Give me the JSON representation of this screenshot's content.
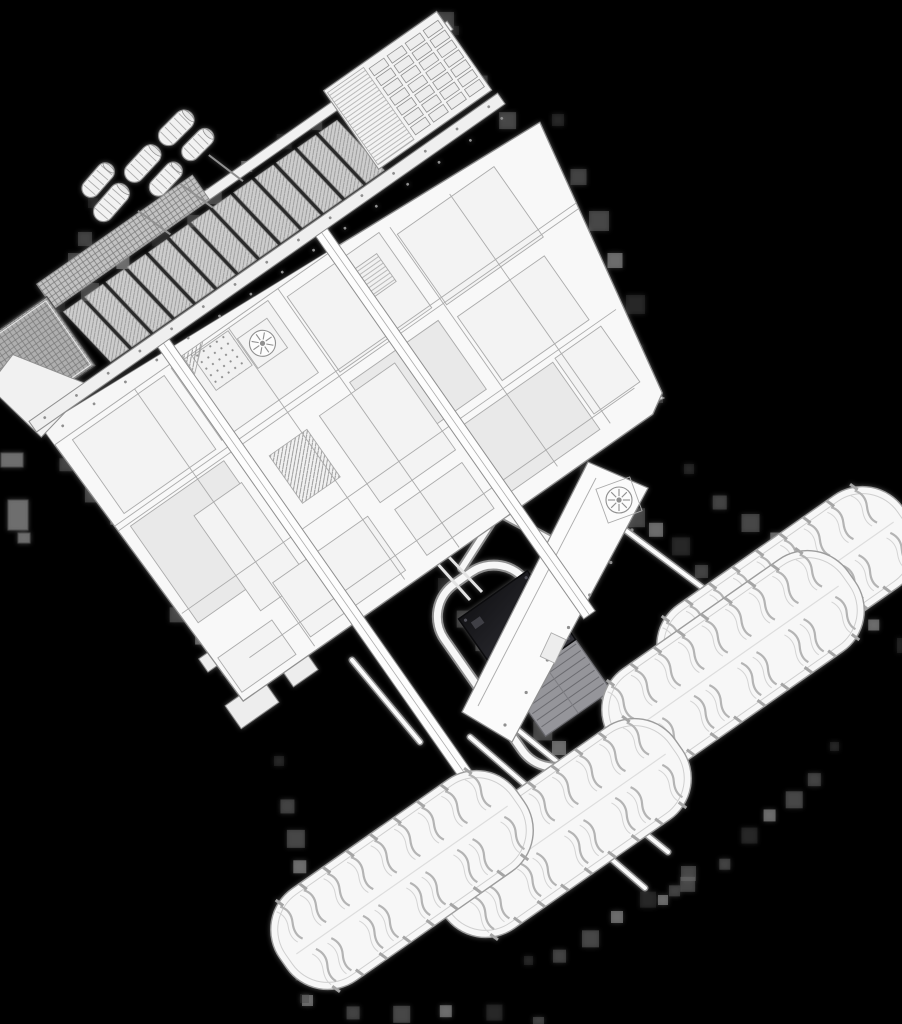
{
  "scene": {
    "description": "Monochrome 3D wireframe render of a combine harvester style machine viewed from above, rotated diagonally on a black background, with slatted header, paneled deck, dark engine block, tubular rear frame, hitch ring and four treaded tires",
    "canvas": {
      "width": 902,
      "height": 1024
    },
    "palette": {
      "background": "#000000",
      "body_fill": "#f8f8f8",
      "panel_base": "#f3f3f3",
      "panel_shaded": "#e9e9e9",
      "part_fill": "#f2f2f2",
      "line_mid": "#8f8f8f",
      "line_soft": "#ababab",
      "line_dark": "#5a5a5a",
      "slat_fill": "#cdcdcd",
      "grid_fill": "#aeaeae",
      "engine_dark_1": "#141417",
      "engine_dark_2": "#303036",
      "engine_rib_fill": "#95959a",
      "engine_rib_line": "#6b6b70",
      "tire_fill": "#f7f7f7",
      "tire_line": "#9c9c9c",
      "tread_line": "#b4b4b4",
      "tread_echo": "#d4d4d4",
      "artifact_grays": [
        "#3c3c3c",
        "#565656",
        "#707070",
        "#8b8b8b"
      ]
    },
    "machine": {
      "anchor_x": 20,
      "anchor_y": 330,
      "rotation_deg": -35
    },
    "header": {
      "front_rail": {
        "x": -45,
        "y": -8,
        "w": 572,
        "h": 10
      },
      "upper_strip": {
        "x": 40,
        "y": -28,
        "w": 190,
        "h": 30
      },
      "slats": {
        "count": 13,
        "x0": 46,
        "step": 26,
        "w": 22,
        "y": 10,
        "h": 68,
        "skew": 10
      },
      "left_grid": {
        "x": -45,
        "y": -12,
        "w": 86,
        "h": 84
      },
      "wing_points": "-58,28 -20,16 26,86 -44,100",
      "sieve": {
        "x": 386,
        "y": -22,
        "w": 138,
        "h": 96,
        "stripe_w": 44,
        "cols": 4,
        "rows": 7,
        "cx0": 436,
        "ry0": -14,
        "colstep": 22,
        "rowstep": 12,
        "cellw": 18,
        "cellh": 9
      },
      "rear_rail": {
        "x": -45,
        "y": 80,
        "w": 572,
        "h": 13
      },
      "rear_bolts": {
        "x1": -30,
        "y1": 86,
        "x2": 512,
        "y2": 86,
        "n": 15,
        "r": 1.4
      },
      "cylinders": [
        {
          "x": 148,
          "y": -52,
          "w": 44,
          "h": 20,
          "rot": -14
        },
        {
          "x": 150,
          "y": -78,
          "w": 40,
          "h": 18,
          "rot": -14
        },
        {
          "x": 196,
          "y": -66,
          "w": 44,
          "h": 20,
          "rot": -12
        },
        {
          "x": 206,
          "y": -40,
          "w": 40,
          "h": 18,
          "rot": -12
        },
        {
          "x": 244,
          "y": -76,
          "w": 42,
          "h": 20,
          "rot": -10
        },
        {
          "x": 252,
          "y": -50,
          "w": 38,
          "h": 18,
          "rot": -10
        }
      ],
      "arms": [
        {
          "x1": 165,
          "y1": -30,
          "x2": 178,
          "y2": 8
        },
        {
          "x1": 215,
          "y1": -28,
          "x2": 228,
          "y2": 10
        },
        {
          "x1": 255,
          "y1": -35,
          "x2": 268,
          "y2": 6
        }
      ]
    },
    "body": {
      "outline_points": "-38,92 545,128 490,420 470,432 -30,432",
      "walkway": {
        "x": -38,
        "y": 92,
        "w": 580,
        "h": 22
      },
      "walkway_bolts": {
        "x1": -20,
        "y1": 103,
        "x2": 516,
        "y2": 103,
        "n": 15,
        "r": 1.4
      },
      "panels": [
        {
          "x": -20,
          "y": 120,
          "w": 112,
          "h": 90,
          "fill": "base"
        },
        {
          "x": -22,
          "y": 224,
          "w": 114,
          "h": 118,
          "fill": "shaded"
        },
        {
          "x": 102,
          "y": 118,
          "w": 118,
          "h": 88,
          "fill": "base"
        },
        {
          "x": 126,
          "y": 120,
          "w": 44,
          "h": 42,
          "fill": "dots"
        },
        {
          "x": 238,
          "y": 126,
          "w": 112,
          "h": 92,
          "fill": "base"
        },
        {
          "x": 240,
          "y": 232,
          "w": 108,
          "h": 84,
          "fill": "shaded"
        },
        {
          "x": 364,
          "y": 138,
          "w": 118,
          "h": 86,
          "fill": "base"
        },
        {
          "x": 366,
          "y": 240,
          "w": 106,
          "h": 78,
          "fill": "base"
        },
        {
          "x": 36,
          "y": 252,
          "w": 58,
          "h": 116,
          "fill": "base"
        },
        {
          "x": 132,
          "y": 246,
          "w": 46,
          "h": 58,
          "fill": "hatch"
        },
        {
          "x": 196,
          "y": 242,
          "w": 92,
          "h": 106,
          "fill": "base"
        },
        {
          "x": 300,
          "y": 332,
          "w": 118,
          "h": 82,
          "fill": "shaded"
        },
        {
          "x": 62,
          "y": 352,
          "w": 116,
          "h": 66,
          "fill": "base"
        },
        {
          "x": 204,
          "y": 362,
          "w": 82,
          "h": 56,
          "fill": "base"
        },
        {
          "x": 422,
          "y": 330,
          "w": 56,
          "h": 68,
          "fill": "base"
        },
        {
          "x": -26,
          "y": 382,
          "w": 66,
          "h": 42,
          "fill": "base"
        },
        {
          "x": 302,
          "y": 142,
          "w": 34,
          "h": 34,
          "fill": "stripes"
        }
      ],
      "lines": [
        {
          "x1": 60,
          "y1": 95,
          "x2": 60,
          "y2": 428
        },
        {
          "x1": 172,
          "y1": 118,
          "x2": 172,
          "y2": 425
        },
        {
          "x1": 235,
          "y1": 95,
          "x2": 235,
          "y2": 430
        },
        {
          "x1": 362,
          "y1": 128,
          "x2": 362,
          "y2": 420
        },
        {
          "x1": 430,
          "y1": 135,
          "x2": 430,
          "y2": 415
        },
        {
          "x1": -36,
          "y1": 215,
          "x2": 540,
          "y2": 215
        },
        {
          "x1": -36,
          "y1": 221,
          "x2": 540,
          "y2": 221
        },
        {
          "x1": -30,
          "y1": 325,
          "x2": 500,
          "y2": 325
        },
        {
          "x1": -38,
          "y1": 114,
          "x2": 543,
          "y2": 114
        },
        {
          "x1": 0,
          "y1": 400,
          "x2": 470,
          "y2": 400
        }
      ],
      "rails": [
        {
          "x": 103,
          "y1": 86,
          "y2": 700,
          "w": 14
        },
        {
          "x": 296,
          "y1": 92,
          "y2": 560,
          "w": 14
        }
      ],
      "hatch_triangle": "118,96 164,96 118,136",
      "fan": {
        "cx": 191,
        "cy": 150,
        "r": 13,
        "spokes": 8
      }
    },
    "rear": {
      "tail_points": "596,362 664,398 598,430",
      "tail_line": {
        "x1": 606,
        "y1": 372,
        "x2": 608,
        "y2": 420
      },
      "loop": {
        "tx": 520,
        "ty": 660,
        "rot": 55,
        "x": -100,
        "y": -50,
        "w": 215,
        "h": 100,
        "rx": 40
      },
      "loop_arms": "M 560 545 L 498 512 L 462 568",
      "pipes": [
        "M 470 600 L 436 562",
        "M 482 592 L 448 556"
      ],
      "engine": {
        "tx": 540,
        "ty": 662,
        "rot": -35,
        "dark": {
          "x": -42,
          "y": -82,
          "w": 84,
          "h": 84
        },
        "rib": {
          "x": -38,
          "y": 0,
          "w": 80,
          "h": 64
        },
        "rib_step": 8
      },
      "side_panel": {
        "points": "588,462 648,488 512,742 462,712",
        "inner_line": {
          "x1": 596,
          "y1": 478,
          "x2": 478,
          "y2": 706
        },
        "fan": {
          "cx": 619,
          "cy": 500,
          "r": 13,
          "spokes": 8,
          "plate_rot": -20
        },
        "bolts": {
          "x1": 632,
          "y1": 530,
          "x2": 505,
          "y2": 725,
          "n": 7,
          "r": 1.6
        },
        "vent": {
          "x": 540,
          "y": 640,
          "w": 26,
          "h": 16,
          "rot": -65
        }
      },
      "hitch": {
        "bracket_points": "590,744 652,764 641,802 600,793",
        "ring": {
          "cx": 628,
          "cy": 795,
          "r": 12.5,
          "r2": 5.5
        }
      },
      "cylinders": [
        {
          "x": 652,
          "y": 737,
          "w": 56,
          "h": 24,
          "rot": 20
        },
        {
          "x": 610,
          "y": 752,
          "w": 46,
          "h": 20,
          "rot": 20
        },
        {
          "x": 576,
          "y": 800,
          "w": 48,
          "h": 20,
          "rot": 18
        },
        {
          "x": 553,
          "y": 820,
          "w": 40,
          "h": 18,
          "rot": 18
        },
        {
          "x": 498,
          "y": 715,
          "w": 46,
          "h": 20,
          "rot": 22
        }
      ],
      "plates": [
        {
          "x": 252,
          "y": 704,
          "w": 46,
          "h": 28,
          "rot": -35,
          "tone": "light"
        },
        {
          "x": 300,
          "y": 670,
          "w": 30,
          "h": 20,
          "rot": -35,
          "tone": "light"
        },
        {
          "x": 214,
          "y": 658,
          "w": 26,
          "h": 16,
          "rot": -35,
          "tone": "light"
        },
        {
          "x": 12,
          "y": 460,
          "w": 22,
          "h": 14,
          "rot": 0,
          "tone": "mid"
        },
        {
          "x": 18,
          "y": 515,
          "w": 20,
          "h": 30,
          "rot": 0,
          "tone": "mid"
        },
        {
          "x": 24,
          "y": 538,
          "w": 12,
          "h": 10,
          "rot": 0,
          "tone": "mid"
        }
      ]
    },
    "beams": [
      {
        "x1": 470,
        "y1": 737,
        "x2": 645,
        "y2": 888
      },
      {
        "x1": 497,
        "y1": 713,
        "x2": 668,
        "y2": 852
      },
      {
        "x1": 585,
        "y1": 500,
        "x2": 703,
        "y2": 588
      },
      {
        "x1": 352,
        "y1": 660,
        "x2": 420,
        "y2": 742
      }
    ],
    "tire_style": {
      "rot": 55,
      "w": 112,
      "h": 290,
      "rx": 50,
      "rows": 9
    },
    "tires": [
      {
        "cx": 788,
        "cy": 596
      },
      {
        "cx": 733,
        "cy": 660
      },
      {
        "cx": 560,
        "cy": 828
      },
      {
        "cx": 402,
        "cy": 880
      }
    ],
    "artifact_segments": [
      {
        "x1": 18,
        "y1": 330,
        "x2": 440,
        "y2": 18,
        "n": 14,
        "s": 10
      },
      {
        "x1": 458,
        "y1": 32,
        "x2": 652,
        "y2": 388,
        "n": 10,
        "s": 9
      },
      {
        "x1": 42,
        "y1": 424,
        "x2": 244,
        "y2": 696,
        "n": 10,
        "s": 9
      },
      {
        "x1": 282,
        "y1": 762,
        "x2": 306,
        "y2": 996,
        "n": 8,
        "s": 10
      },
      {
        "x1": 308,
        "y1": 1000,
        "x2": 526,
        "y2": 1012,
        "n": 6,
        "s": 9
      },
      {
        "x1": 532,
        "y1": 962,
        "x2": 688,
        "y2": 864,
        "n": 7,
        "s": 9
      },
      {
        "x1": 692,
        "y1": 470,
        "x2": 898,
        "y2": 642,
        "n": 9,
        "s": 10
      },
      {
        "x1": 838,
        "y1": 748,
        "x2": 662,
        "y2": 896,
        "n": 8,
        "s": 9
      },
      {
        "x1": 446,
        "y1": 584,
        "x2": 556,
        "y2": 742,
        "n": 8,
        "s": 13
      },
      {
        "x1": 588,
        "y1": 472,
        "x2": 688,
        "y2": 560,
        "n": 6,
        "s": 11
      },
      {
        "x1": 96,
        "y1": 204,
        "x2": 44,
        "y2": 300,
        "n": 5,
        "s": 10
      },
      {
        "x1": 560,
        "y1": 120,
        "x2": 622,
        "y2": 300,
        "n": 5,
        "s": 12
      }
    ]
  }
}
